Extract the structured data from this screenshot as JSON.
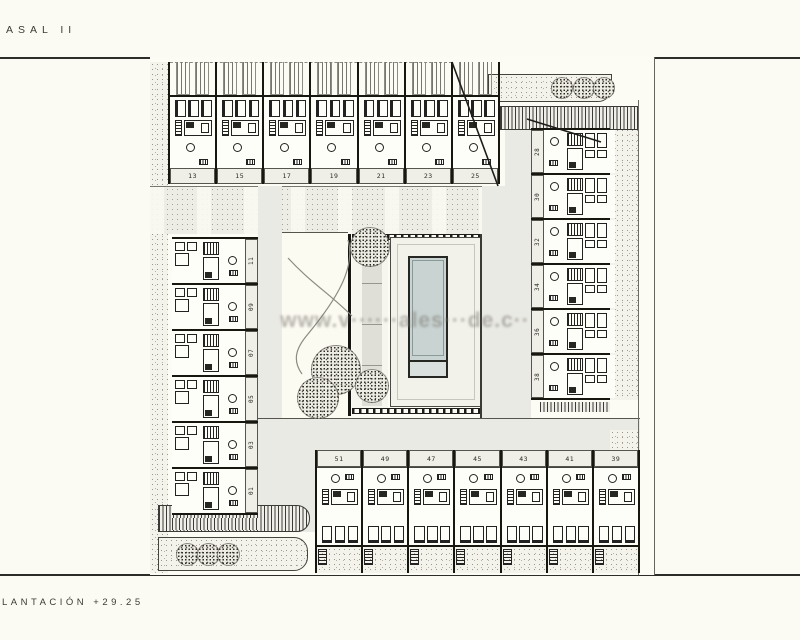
{
  "title": "ASAL II",
  "caption": "LANTACIÓN +29.25",
  "watermark": "www.v······ales···de.c··",
  "plan": {
    "top_row": [
      "13",
      "15",
      "17",
      "19",
      "21",
      "23",
      "25"
    ],
    "left_column": [
      "11",
      "09",
      "07",
      "05",
      "03",
      "01"
    ],
    "right_column": [
      "28",
      "30",
      "32",
      "34",
      "36",
      "38"
    ],
    "bottom_row": [
      "51",
      "49",
      "47",
      "45",
      "43",
      "41",
      "39"
    ]
  },
  "colors": {
    "paper": "#FCFBF3",
    "ink": "#1d1d1a",
    "corridor": "#EAEAE4",
    "label_bg": "#EFEFE8",
    "pool_water": "#C9D3D1",
    "watermark_gray": "#76746E"
  }
}
